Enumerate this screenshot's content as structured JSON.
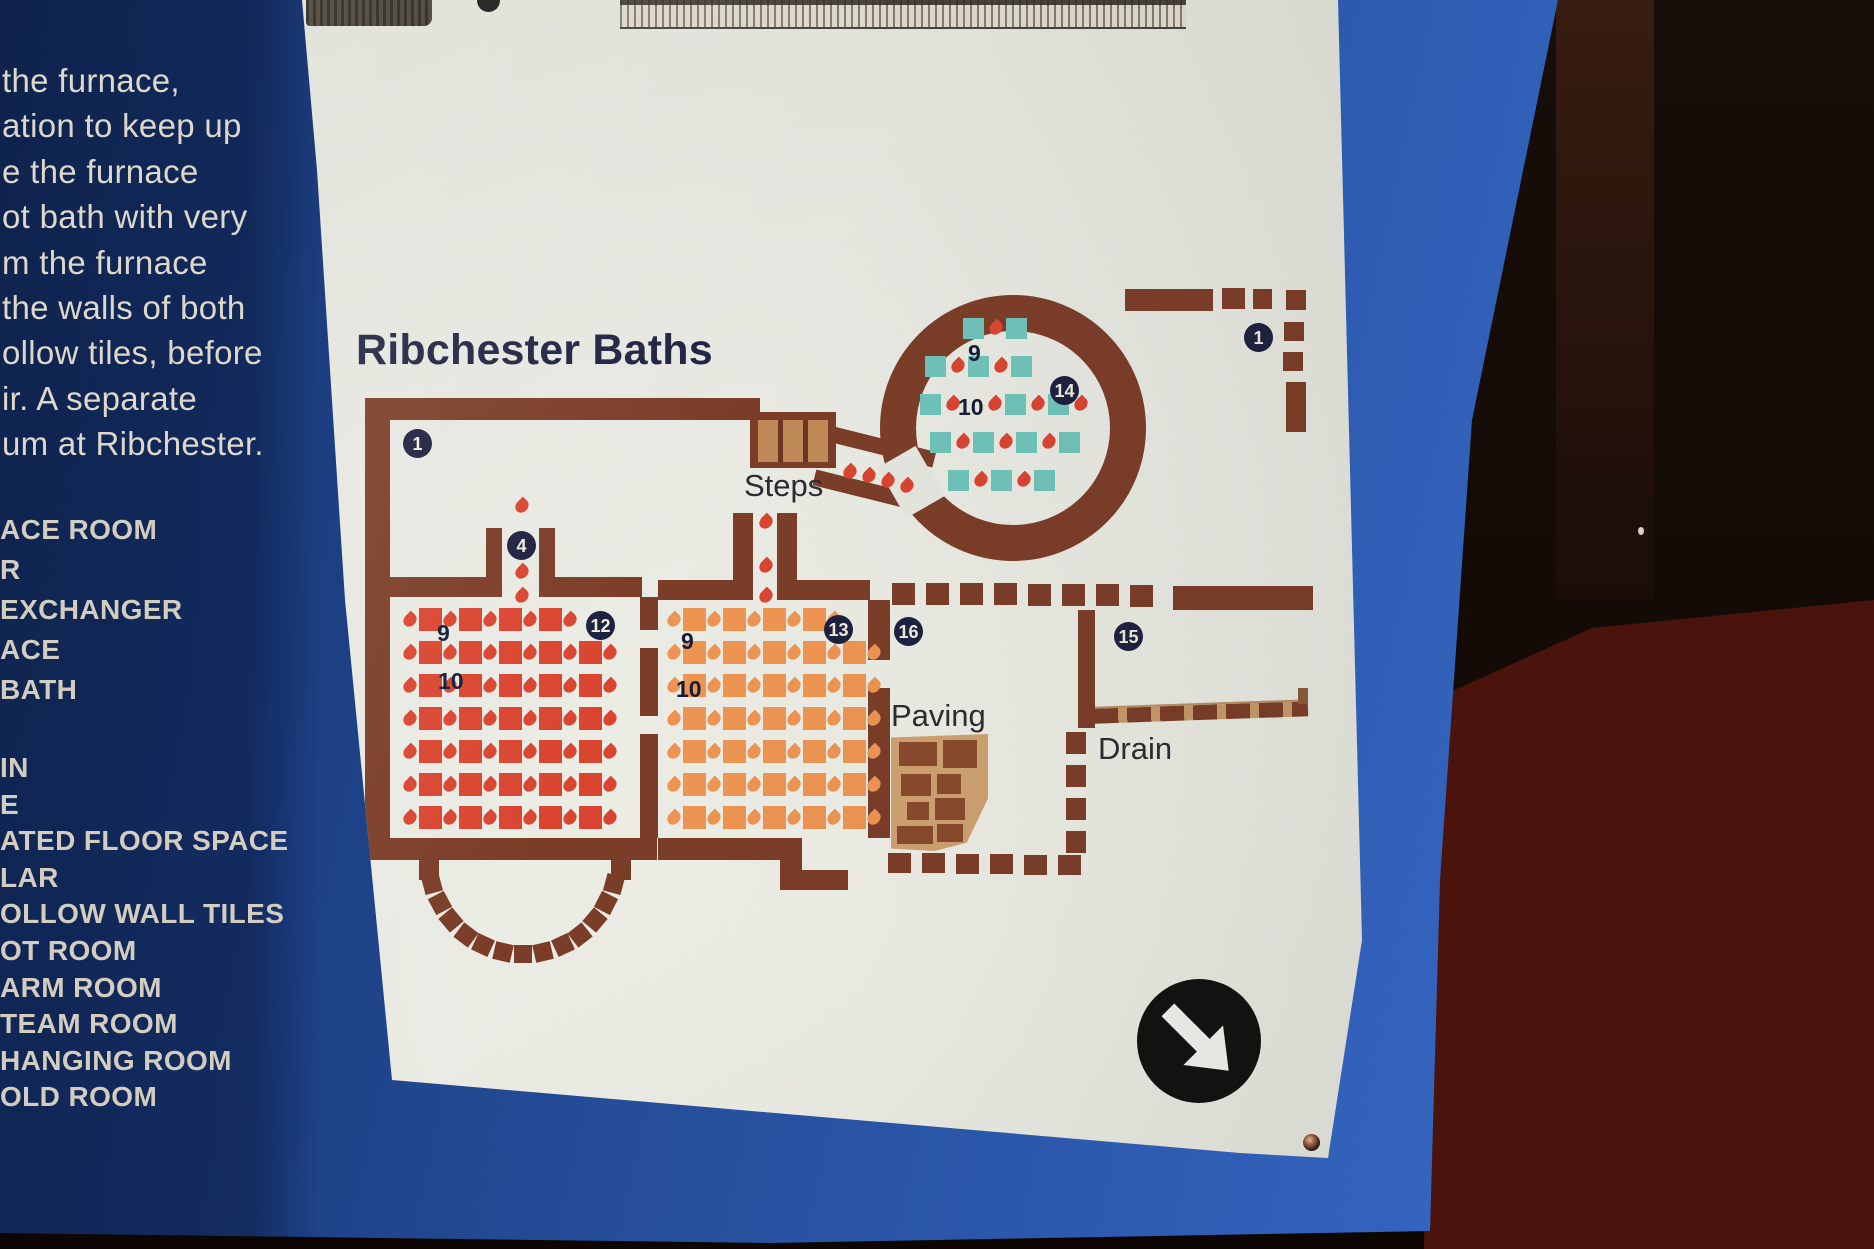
{
  "sidebar": {
    "paragraph_lines": [
      "the furnace,",
      "ation to keep up",
      "e the furnace",
      "ot bath with very",
      "m the furnace",
      "the walls of both",
      "ollow tiles, before",
      "ir. A separate",
      "um at Ribchester."
    ],
    "legend_lines": [
      "ACE ROOM",
      "R",
      "EXCHANGER",
      "ACE",
      "BATH",
      "IN",
      "E",
      "ATED FLOOR SPACE",
      "LAR",
      "OLLOW WALL TILES",
      "OT ROOM",
      "ARM ROOM",
      "TEAM ROOM",
      "HANGING ROOM",
      "OLD ROOM"
    ]
  },
  "map": {
    "title": "Ribchester Baths",
    "labels": {
      "steps": "Steps",
      "paving": "Paving",
      "drain": "Drain"
    },
    "colors": {
      "wall": "#7b3d28",
      "flame": "#d94530",
      "pilae_hot": "#da4530",
      "pilae_warm": "#ef9552",
      "teal": "#70c3ba",
      "badge": "#1d2140",
      "board_blue": "#2e5cb2",
      "panel": "#e7e8e1",
      "steps_tan": "#c08a58",
      "paving_tan": "#cfa271",
      "drain_tan": "#c89a6a"
    },
    "badges": [
      {
        "n": "1",
        "x": 417,
        "y": 443
      },
      {
        "n": "4",
        "x": 521,
        "y": 545
      },
      {
        "n": "12",
        "x": 600,
        "y": 625
      },
      {
        "n": "13",
        "x": 838,
        "y": 629
      },
      {
        "n": "16",
        "x": 908,
        "y": 631
      },
      {
        "n": "15",
        "x": 1128,
        "y": 636
      },
      {
        "n": "14",
        "x": 1064,
        "y": 390
      },
      {
        "n": "1",
        "x": 1258,
        "y": 337
      }
    ],
    "room_numbers": [
      {
        "n": "9",
        "x": 437,
        "y": 622
      },
      {
        "n": "10",
        "x": 438,
        "y": 670
      },
      {
        "n": "9",
        "x": 681,
        "y": 630
      },
      {
        "n": "10",
        "x": 676,
        "y": 678
      },
      {
        "n": "9",
        "x": 968,
        "y": 342
      },
      {
        "n": "10",
        "x": 958,
        "y": 396
      }
    ],
    "walls": [
      [
        365,
        398,
        395,
        22
      ],
      [
        365,
        398,
        25,
        462
      ],
      [
        365,
        838,
        292,
        22
      ],
      [
        419,
        858,
        20,
        22
      ],
      [
        611,
        858,
        20,
        22
      ],
      [
        390,
        577,
        98,
        20
      ],
      [
        486,
        528,
        16,
        69
      ],
      [
        539,
        528,
        16,
        69
      ],
      [
        555,
        577,
        87,
        20
      ],
      [
        640,
        597,
        18,
        33
      ],
      [
        640,
        648,
        18,
        68
      ],
      [
        640,
        734,
        18,
        104
      ],
      [
        658,
        580,
        75,
        20
      ],
      [
        733,
        513,
        20,
        87
      ],
      [
        777,
        513,
        20,
        87
      ],
      [
        797,
        580,
        73,
        20
      ],
      [
        868,
        600,
        22,
        60
      ],
      [
        868,
        688,
        22,
        150
      ],
      [
        658,
        838,
        122,
        22
      ],
      [
        780,
        838,
        22,
        52
      ],
      [
        802,
        870,
        46,
        20
      ],
      [
        1173,
        586,
        140,
        24
      ],
      [
        1078,
        610,
        17,
        118
      ],
      [
        1125,
        289,
        88,
        22
      ],
      [
        1286,
        382,
        20,
        50
      ]
    ],
    "dashes": [
      [
        605,
        875,
        18,
        18,
        105
      ],
      [
        597,
        894,
        18,
        18,
        117
      ],
      [
        586,
        911,
        18,
        18,
        130
      ],
      [
        571,
        926,
        18,
        18,
        142
      ],
      [
        554,
        936,
        18,
        18,
        155
      ],
      [
        534,
        943,
        18,
        18,
        167
      ],
      [
        514,
        945,
        18,
        18,
        180
      ],
      [
        494,
        943,
        18,
        18,
        193
      ],
      [
        474,
        936,
        18,
        18,
        205
      ],
      [
        457,
        926,
        18,
        18,
        217
      ],
      [
        442,
        911,
        18,
        18,
        230
      ],
      [
        431,
        894,
        18,
        18,
        242
      ],
      [
        423,
        875,
        18,
        18,
        255
      ],
      [
        892,
        583,
        23,
        22,
        0
      ],
      [
        926,
        583,
        23,
        22,
        0
      ],
      [
        960,
        583,
        23,
        22,
        0
      ],
      [
        994,
        583,
        23,
        22,
        0
      ],
      [
        1028,
        584,
        23,
        22,
        0
      ],
      [
        1062,
        584,
        23,
        22,
        0
      ],
      [
        1096,
        584,
        23,
        22,
        0
      ],
      [
        1130,
        585,
        23,
        22,
        0
      ],
      [
        888,
        853,
        23,
        20,
        0
      ],
      [
        922,
        853,
        23,
        20,
        0
      ],
      [
        956,
        854,
        23,
        20,
        0
      ],
      [
        990,
        854,
        23,
        20,
        0
      ],
      [
        1024,
        855,
        23,
        20,
        0
      ],
      [
        1058,
        855,
        23,
        20,
        0
      ],
      [
        1066,
        732,
        20,
        22,
        0
      ],
      [
        1066,
        765,
        20,
        22,
        0
      ],
      [
        1066,
        798,
        20,
        22,
        0
      ],
      [
        1066,
        831,
        20,
        22,
        0
      ],
      [
        1222,
        288,
        23,
        21,
        0
      ],
      [
        1253,
        289,
        19,
        20,
        0
      ],
      [
        1286,
        290,
        20,
        20,
        0
      ],
      [
        1284,
        322,
        20,
        19,
        0
      ],
      [
        1283,
        352,
        20,
        19,
        0
      ]
    ],
    "pilae": [
      {
        "x": 404,
        "y": 608,
        "dx": 40,
        "dy": 33,
        "rows": 7,
        "cols": 5,
        "cols0": 4,
        "size": 23,
        "color": "#da4530"
      },
      {
        "x": 668,
        "y": 608,
        "dx": 40,
        "dy": 33,
        "rows": 7,
        "cols": 5,
        "cols0": 4,
        "size": 23,
        "color": "#ef9552"
      }
    ],
    "circle_grid": {
      "rows": [
        {
          "x": 963,
          "y": 318,
          "seq": "sfs"
        },
        {
          "x": 925,
          "y": 356,
          "seq": "sfsfs"
        },
        {
          "x": 920,
          "y": 394,
          "seq": "sf_fsfsf"
        },
        {
          "x": 930,
          "y": 432,
          "seq": "sfsfsfs"
        },
        {
          "x": 948,
          "y": 470,
          "seq": "sfsfs"
        }
      ]
    },
    "flames": [
      [
        516,
        500
      ],
      [
        516,
        566
      ],
      [
        516,
        590
      ],
      [
        760,
        516
      ],
      [
        760,
        560
      ],
      [
        760,
        590
      ],
      [
        844,
        466
      ],
      [
        863,
        470
      ],
      [
        882,
        475
      ],
      [
        901,
        480
      ]
    ],
    "paving_stones": [
      [
        8,
        8,
        38,
        24
      ],
      [
        52,
        6,
        34,
        28
      ],
      [
        10,
        40,
        30,
        22
      ],
      [
        46,
        40,
        24,
        20
      ],
      [
        16,
        68,
        22,
        18
      ],
      [
        44,
        64,
        30,
        22
      ],
      [
        6,
        92,
        36,
        18
      ],
      [
        46,
        90,
        26,
        18
      ]
    ]
  }
}
